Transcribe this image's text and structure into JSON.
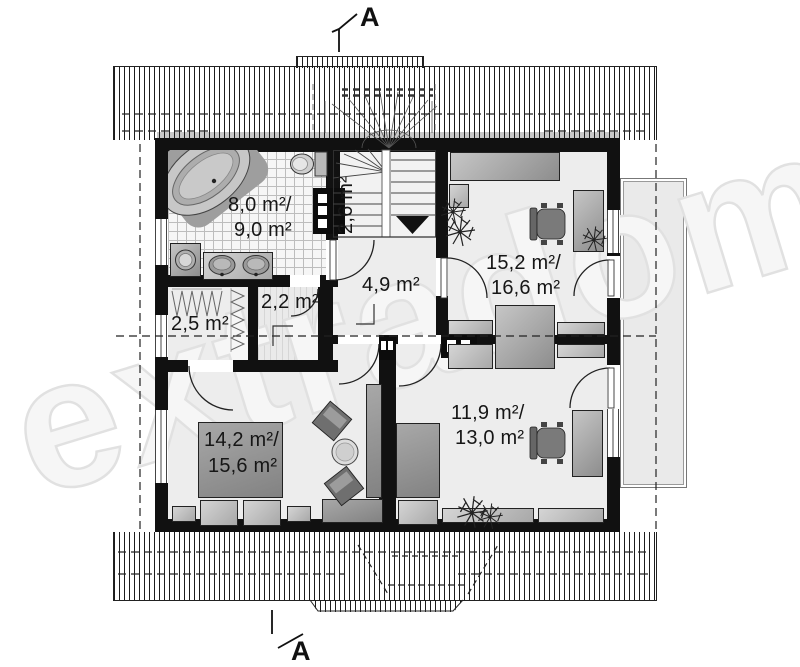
{
  "plan": {
    "watermark": "extradom",
    "section_marker_top": "A",
    "section_marker_bottom": "A",
    "rooms": {
      "bathroom": {
        "area": "8,0 m²/",
        "area_alt": "9,0 m²"
      },
      "stairs": {
        "area": "2,6 m²"
      },
      "hall": {
        "area": "4,9 m²"
      },
      "wardrobe": {
        "area": "2,5 m²"
      },
      "storage": {
        "area": "2,2 m²"
      },
      "bedroom_top_right": {
        "area": "15,2 m²/",
        "area_alt": "16,6 m²"
      },
      "bedroom_bottom_left": {
        "area": "14,2 m²/",
        "area_alt": "15,6 m²"
      },
      "bedroom_bottom_right": {
        "area": "11,9 m²/",
        "area_alt": "13,0 m²"
      }
    }
  }
}
